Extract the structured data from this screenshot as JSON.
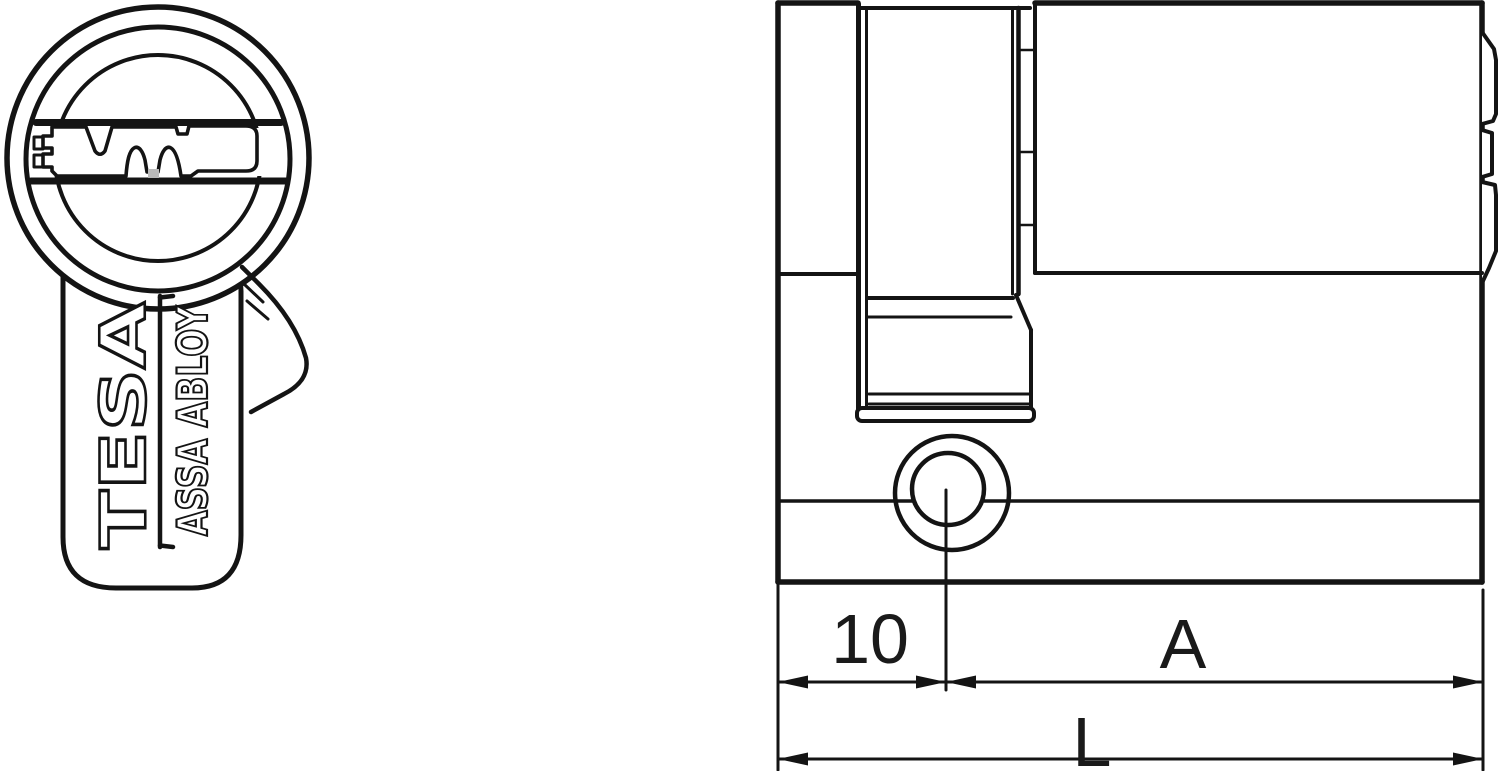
{
  "figure": {
    "type": "technical-drawing",
    "subject": "euro profile half cylinder lock",
    "background": "#ffffff",
    "line_color": "#141414",
    "front_view": {
      "brand_primary": "TESA",
      "brand_secondary": "ASSA ABLOY"
    },
    "side_view": {
      "dimensions": {
        "rear_to_screw_center": "10",
        "screw_center_to_front": "A",
        "total_length": "L"
      }
    }
  }
}
